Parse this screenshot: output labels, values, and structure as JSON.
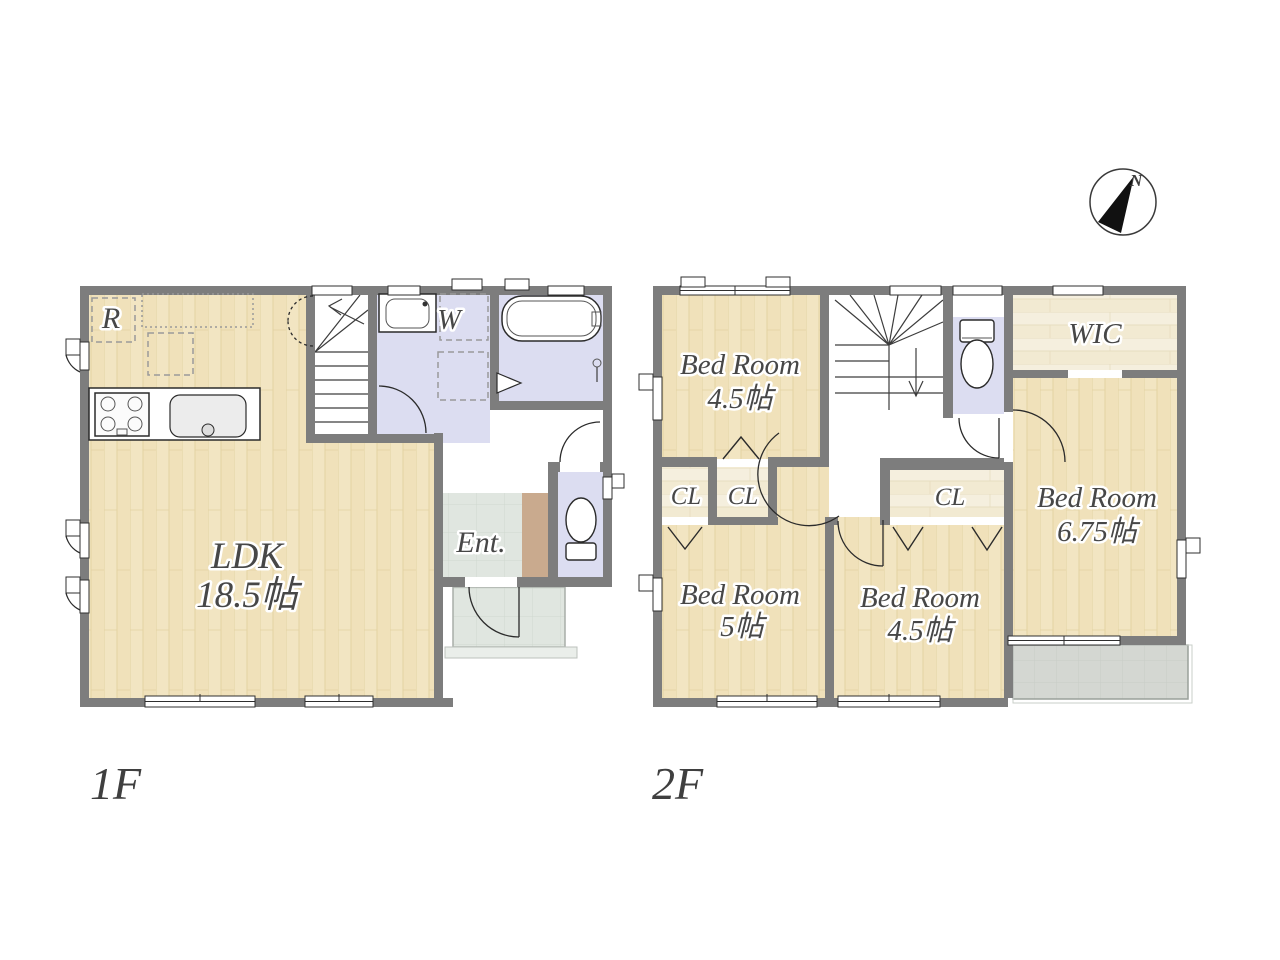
{
  "compass": {
    "label": "N"
  },
  "floors": [
    {
      "label": "1F",
      "rooms": [
        {
          "id": "ldk",
          "label": "LDK",
          "size": "18.5帖"
        },
        {
          "id": "refrigerator",
          "label": "R"
        },
        {
          "id": "washroom",
          "label": "W"
        },
        {
          "id": "entrance",
          "label": "Ent."
        }
      ]
    },
    {
      "label": "2F",
      "rooms": [
        {
          "id": "bedroom-top-left",
          "label": "Bed Room",
          "size": "4.5帖"
        },
        {
          "id": "wic",
          "label": "WIC"
        },
        {
          "id": "bedroom-right",
          "label": "Bed Room",
          "size": "6.75帖"
        },
        {
          "id": "closet-left",
          "label": "CL"
        },
        {
          "id": "closet-mid",
          "label": "CL"
        },
        {
          "id": "closet-center",
          "label": "CL"
        },
        {
          "id": "bedroom-bottom-left",
          "label": "Bed Room",
          "size": "5帖"
        },
        {
          "id": "bedroom-bottom-center",
          "label": "Bed Room",
          "size": "4.5帖"
        }
      ]
    }
  ],
  "colors": {
    "wall": "#7d7d7d",
    "wood_floor": "#f2e5c2",
    "closet_floor": "#f5efde",
    "wet_room_floor": "#dcddf1",
    "entrance_tile": "#e0e6e0",
    "balcony_tile": "#d4d7d2",
    "step": "#c9aa8e",
    "label_text": "#474747"
  }
}
